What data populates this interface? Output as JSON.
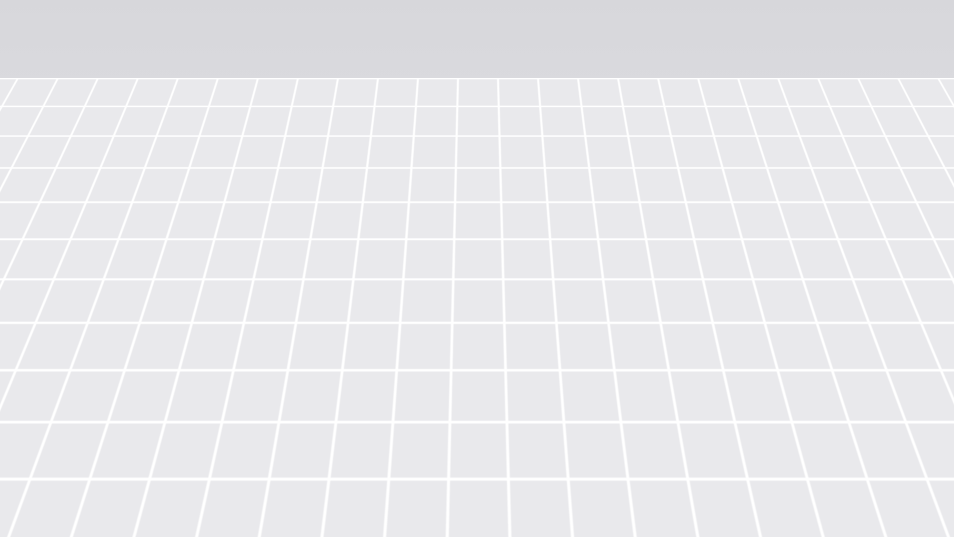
{
  "app": {
    "aria_label": "3D floor plan viewport"
  },
  "palette": {
    "backdrop_top": "#d7d7db",
    "backdrop_bottom": "#efeff2",
    "ground_tile": "#e9e9ec",
    "ground_line": "#ffffff",
    "floor": "#fafafb",
    "wall_bright": "#ffffff",
    "wall_shade": "#f0f0f3",
    "wall_top": "#e8e8ec",
    "grass": "#79a73f",
    "wood_desk": "#ab855c",
    "wood_dark": "#96744c",
    "sofa": "#3a2e25",
    "bed_navy": "#22407a",
    "bed_linen": "#e7e8ea",
    "metal_black": "#26262a",
    "door_gray": "#a6a6a9",
    "door_frame_brown": "#9a4a1e",
    "cabinet_gray": "#d9d9dc",
    "shelf_wood": "#5f462c",
    "plant_green": "#7d9b4f",
    "chair_plum": "#41202d",
    "laptop_purple": "#7d3a96",
    "accent_blue": "#5b9bd5",
    "rug_tan": "#cfc49a",
    "copper_shelf": "#b5762f"
  },
  "scene": {
    "objects": [
      {
        "id": "viewport",
        "name": "3D floor plan viewport"
      },
      {
        "id": "ground-grid",
        "name": "Ground grid"
      },
      {
        "id": "grass-lawn",
        "name": "Grass lawn"
      },
      {
        "id": "room-floor",
        "name": "Room floor"
      },
      {
        "id": "left-wall",
        "name": "Left wall"
      },
      {
        "id": "back-wall",
        "name": "Back wall"
      },
      {
        "id": "right-wall",
        "name": "Right wall"
      },
      {
        "id": "window",
        "name": "Window"
      },
      {
        "id": "back-door",
        "name": "Back door"
      },
      {
        "id": "open-door-frame",
        "name": "Open door frame"
      },
      {
        "id": "partition-panel",
        "name": "Partition panel"
      },
      {
        "id": "backsplash-panel",
        "name": "Whiteboard panel"
      },
      {
        "id": "clothing-rack",
        "name": "Clothing rack with clothes"
      },
      {
        "id": "bed",
        "name": "Double bed"
      },
      {
        "id": "nightstand",
        "name": "Nightstand"
      },
      {
        "id": "wall-decor",
        "name": "Wall decor"
      },
      {
        "id": "plant-shelf",
        "name": "Plant shelf divider"
      },
      {
        "id": "sofa",
        "name": "Sofa"
      },
      {
        "id": "desk",
        "name": "L-shaped desk"
      },
      {
        "id": "office-chair",
        "name": "Office chair"
      },
      {
        "id": "laptop",
        "name": "Laptop"
      },
      {
        "id": "keyboard",
        "name": "Keyboard"
      },
      {
        "id": "desk-lamp",
        "name": "Desk organizer"
      },
      {
        "id": "bar-table",
        "name": "Bar table"
      },
      {
        "id": "tan-chair",
        "name": "Chair"
      },
      {
        "id": "bar-stool",
        "name": "Bar stool"
      },
      {
        "id": "tall-cabinet",
        "name": "Tall cabinet"
      },
      {
        "id": "kitchen-counter",
        "name": "Kitchen counter"
      },
      {
        "id": "stove",
        "name": "Stove"
      },
      {
        "id": "faucet",
        "name": "Faucet"
      },
      {
        "id": "kitchen-shelves",
        "name": "Kitchen wall shelves"
      },
      {
        "id": "base-cabinet",
        "name": "Base cabinet"
      },
      {
        "id": "rug",
        "name": "Rug"
      },
      {
        "id": "outdoor-unit",
        "name": "Outdoor unit"
      },
      {
        "id": "wall-fixture",
        "name": "Wall fixture"
      }
    ]
  }
}
